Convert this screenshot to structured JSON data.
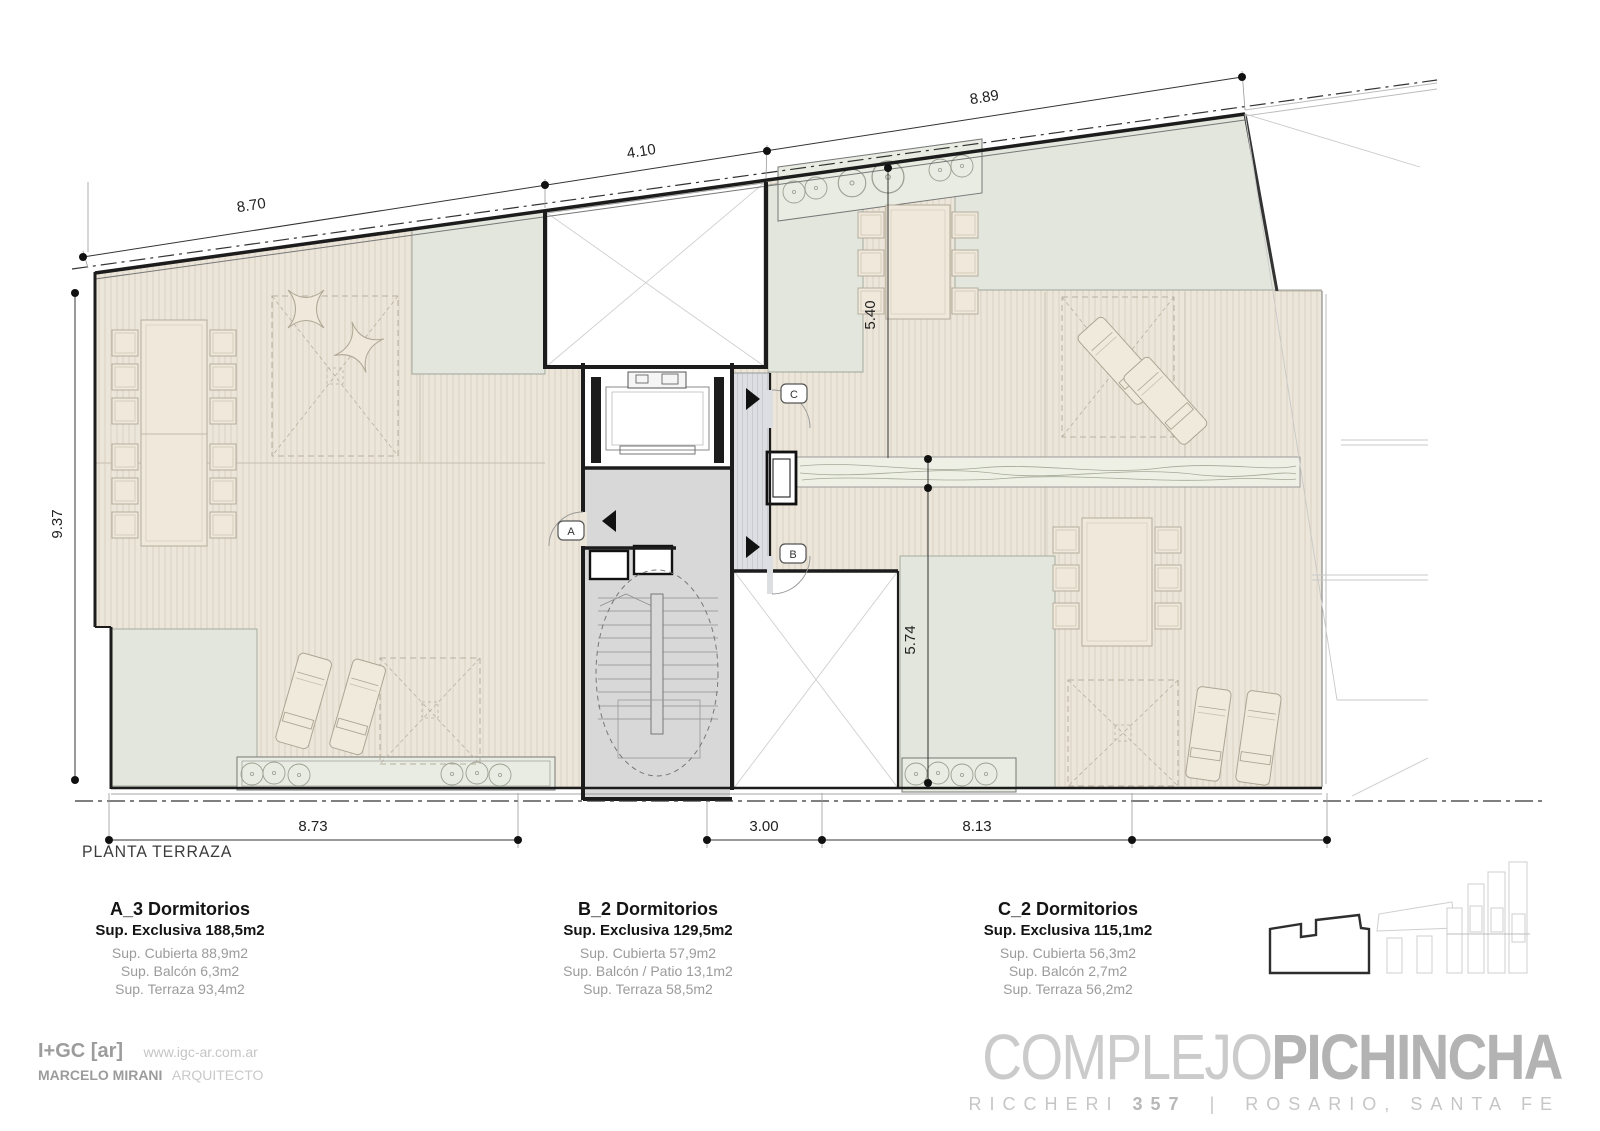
{
  "plan": {
    "title": "PLANTA TERRAZA",
    "dims": {
      "top_1": "8.70",
      "top_2": "4.10",
      "top_3": "8.89",
      "left": "9.37",
      "mid_upper": "5.40",
      "mid_lower": "5.74",
      "bottom_1": "8.73",
      "bottom_2": "3.00",
      "bottom_3": "8.13"
    },
    "doors": {
      "a": "A",
      "b": "B",
      "c": "C"
    }
  },
  "units": [
    {
      "name": "A_3 Dormitorios",
      "exclusiva": "Sup. Exclusiva 188,5m2",
      "lines": [
        "Sup. Cubierta 88,9m2",
        "Sup. Balcón 6,3m2",
        "Sup. Terraza 93,4m2"
      ]
    },
    {
      "name": "B_2 Dormitorios",
      "exclusiva": "Sup. Exclusiva 129,5m2",
      "lines": [
        "Sup. Cubierta 57,9m2",
        "Sup. Balcón / Patio 13,1m2",
        "Sup. Terraza 58,5m2"
      ]
    },
    {
      "name": "C_2 Dormitorios",
      "exclusiva": "Sup. Exclusiva 115,1m2",
      "lines": [
        "Sup. Cubierta 56,3m2",
        "Sup. Balcón 2,7m2",
        "Sup. Terraza 56,2m2"
      ]
    }
  ],
  "footer": {
    "firm": "I+GC [ar]",
    "website": "www.igc-ar.com.ar",
    "architect": "MARCELO MIRANI",
    "role": "ARQUITECTO"
  },
  "brand": {
    "name_light": "COMPLEJO",
    "name_bold": "PICHINCHA",
    "street": "RICCHERI",
    "number": "357",
    "separator": "|",
    "city": "ROSARIO,",
    "province": "SANTA FE"
  },
  "colors": {
    "deck": "#ece6da",
    "deck_stripe": "#d9d0c1",
    "sage": "#e3e6dd",
    "core": "#d8d8d8",
    "corridor": "#dddee2",
    "wall": "#1c1c1c",
    "muted_text": "#9b9b9b",
    "brand_gray": "#bfbfbf"
  }
}
